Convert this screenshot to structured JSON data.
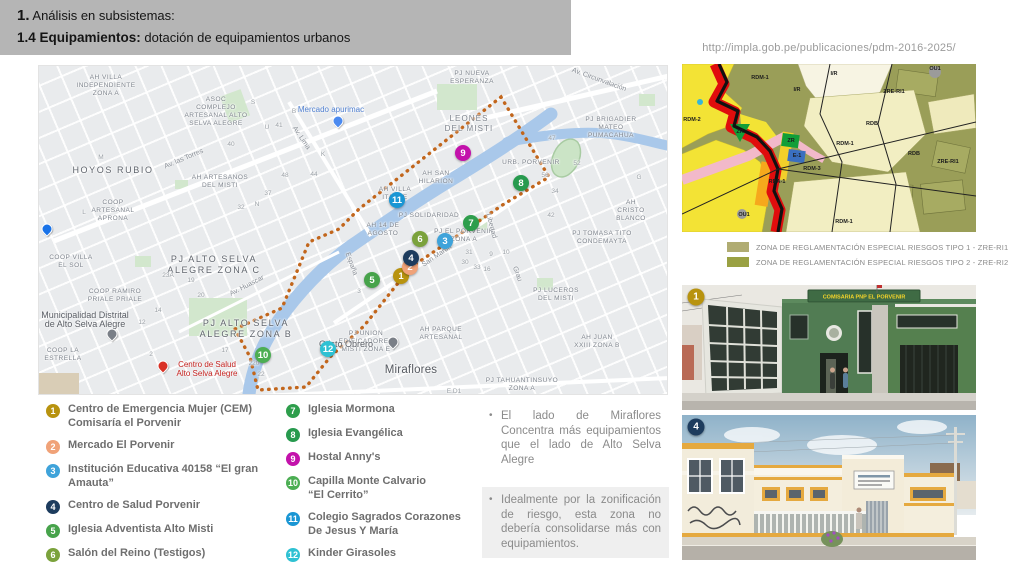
{
  "header": {
    "num1": "1.",
    "title1": " Análisis en subsistemas:",
    "num2": "1.4 Equipamientos:",
    "title2": " dotación de equipamientos urbanos"
  },
  "source_url": "http://impla.gob.pe/publicaciones/pdm-2016-2025/",
  "map": {
    "boundary_color": "#c2661c",
    "markers": [
      {
        "n": "9",
        "x": 424,
        "y": 87,
        "color": "#c312ab"
      },
      {
        "n": "8",
        "x": 482,
        "y": 117,
        "color": "#279a4e"
      },
      {
        "n": "7",
        "x": 432,
        "y": 157,
        "color": "#2e9e4c"
      },
      {
        "n": "6",
        "x": 381,
        "y": 173,
        "color": "#7ba23c"
      },
      {
        "n": "3",
        "x": 406,
        "y": 175,
        "color": "#3fa3da"
      },
      {
        "n": "5",
        "x": 333,
        "y": 214,
        "color": "#47a34b"
      },
      {
        "n": "11",
        "x": 358,
        "y": 134,
        "color": "#1a96d4"
      },
      {
        "n": "10",
        "x": 224,
        "y": 289,
        "color": "#4cae53"
      },
      {
        "n": "12",
        "x": 289,
        "y": 283,
        "color": "#2fc1d3"
      },
      {
        "n": "1",
        "x": 362,
        "y": 210,
        "color": "#b8930f"
      },
      {
        "n": "2",
        "x": 371,
        "y": 201,
        "color": "#f0a278"
      },
      {
        "n": "4",
        "x": 372,
        "y": 192,
        "color": "#1d3c5e"
      }
    ],
    "labels": [
      {
        "t": "AH VILLA\nINDEPENDIENTE\nZONA A",
        "x": 67,
        "y": 8
      },
      {
        "t": "ASOC\nCOMPLEJO\nARTESANAL ALTO\nSELVA ALEGRE",
        "x": 177,
        "y": 30
      },
      {
        "t": "PJ NUEVA\nESPERANZA",
        "x": 433,
        "y": 4
      },
      {
        "t": "LEONES\nDEL MISTI",
        "x": 430,
        "y": 48,
        "cls": "area-lg"
      },
      {
        "t": "PJ BRIGADIER\nMATEO\nPUMACAHUA",
        "x": 572,
        "y": 50
      },
      {
        "t": "HOYOS RUBIO",
        "x": 74,
        "y": 99,
        "cls": "big"
      },
      {
        "t": "AH ARTESANOS\nDEL MISTI",
        "x": 181,
        "y": 108
      },
      {
        "t": "COOP\nARTESANAL\nAPRONA",
        "x": 74,
        "y": 133
      },
      {
        "t": "AH SAN\nHILARION",
        "x": 397,
        "y": 104
      },
      {
        "t": "URB. PORVENIR",
        "x": 492,
        "y": 93
      },
      {
        "t": "AH VILLA\nITARTE",
        "x": 356,
        "y": 120
      },
      {
        "t": "AH CRISTO\nBLANCO",
        "x": 592,
        "y": 133
      },
      {
        "t": "PJ SOLIDARIDAD",
        "x": 390,
        "y": 146
      },
      {
        "t": "AH 14 DE\nAGOSTO",
        "x": 344,
        "y": 156
      },
      {
        "t": "PJ EL PORVENIR\nZONA A",
        "x": 425,
        "y": 162
      },
      {
        "t": "PJ TOMASA TITO\nCONDEMAYTA",
        "x": 563,
        "y": 164
      },
      {
        "t": "PJ ALTO SELVA\nALEGRE ZONA C",
        "x": 175,
        "y": 188,
        "cls": "big"
      },
      {
        "t": "COOP VILLA\nEL SOL",
        "x": 32,
        "y": 188
      },
      {
        "t": "COOP RAMIRO\nPRIALE PRIALE",
        "x": 76,
        "y": 222
      },
      {
        "t": "PJ ALTO SELVA\nALEGRE ZONA B",
        "x": 207,
        "y": 252,
        "cls": "big"
      },
      {
        "t": "PJ UNION\nEDIFICADORES\nMISTI ZONA E",
        "x": 327,
        "y": 264
      },
      {
        "t": "AH PARQUE\nARTESANAL",
        "x": 402,
        "y": 260
      },
      {
        "t": "PJ LUCEROS\nDEL MISTI",
        "x": 517,
        "y": 221
      },
      {
        "t": "COOP LA\nESTRELLA",
        "x": 24,
        "y": 281
      },
      {
        "t": "PJ TAHUANTINSUYO\nZONA A",
        "x": 483,
        "y": 311
      },
      {
        "t": "AH JUAN\nXXIII ZONA B",
        "x": 558,
        "y": 268
      },
      {
        "t": "Miraflores",
        "x": 372,
        "y": 298,
        "cls": "city"
      },
      {
        "t": "40",
        "x": 192,
        "y": 75,
        "cls": "num"
      },
      {
        "t": "41",
        "x": 240,
        "y": 56,
        "cls": "num"
      },
      {
        "t": "48",
        "x": 246,
        "y": 106,
        "cls": "num"
      },
      {
        "t": "44",
        "x": 275,
        "y": 105,
        "cls": "num"
      },
      {
        "t": "37",
        "x": 229,
        "y": 124,
        "cls": "num"
      },
      {
        "t": "32",
        "x": 202,
        "y": 138,
        "cls": "num"
      },
      {
        "t": "52",
        "x": 538,
        "y": 94,
        "cls": "num"
      },
      {
        "t": "47",
        "x": 513,
        "y": 69,
        "cls": "num"
      },
      {
        "t": "56",
        "x": 506,
        "y": 106,
        "cls": "num"
      },
      {
        "t": "34",
        "x": 516,
        "y": 122,
        "cls": "num"
      },
      {
        "t": "42",
        "x": 512,
        "y": 146,
        "cls": "num"
      },
      {
        "t": "23A",
        "x": 129,
        "y": 206,
        "cls": "num"
      },
      {
        "t": "19",
        "x": 152,
        "y": 211,
        "cls": "num"
      },
      {
        "t": "20",
        "x": 162,
        "y": 226,
        "cls": "num"
      },
      {
        "t": "14",
        "x": 119,
        "y": 241,
        "cls": "num"
      },
      {
        "t": "12",
        "x": 103,
        "y": 253,
        "cls": "num"
      },
      {
        "t": "17",
        "x": 186,
        "y": 281,
        "cls": "num"
      },
      {
        "t": "220",
        "x": 215,
        "y": 294,
        "cls": "num"
      },
      {
        "t": "22",
        "x": 222,
        "y": 305,
        "cls": "num"
      },
      {
        "t": "31",
        "x": 430,
        "y": 183,
        "cls": "num"
      },
      {
        "t": "30",
        "x": 426,
        "y": 193,
        "cls": "num"
      },
      {
        "t": "33",
        "x": 438,
        "y": 198,
        "cls": "num"
      },
      {
        "t": "9",
        "x": 452,
        "y": 185,
        "cls": "num"
      },
      {
        "t": "10",
        "x": 467,
        "y": 183,
        "cls": "num"
      },
      {
        "t": "16",
        "x": 448,
        "y": 200,
        "cls": "num"
      },
      {
        "t": "3",
        "x": 320,
        "y": 222,
        "cls": "num"
      },
      {
        "t": "2",
        "x": 112,
        "y": 285,
        "cls": "num"
      },
      {
        "t": "B",
        "x": 255,
        "y": 42,
        "cls": "num"
      },
      {
        "t": "S",
        "x": 214,
        "y": 33,
        "cls": "num"
      },
      {
        "t": "M",
        "x": 62,
        "y": 88,
        "cls": "num"
      },
      {
        "t": "N",
        "x": 218,
        "y": 135,
        "cls": "num"
      },
      {
        "t": "K",
        "x": 284,
        "y": 85,
        "cls": "num"
      },
      {
        "t": "U",
        "x": 228,
        "y": 58,
        "cls": "num"
      },
      {
        "t": "L",
        "x": 45,
        "y": 143,
        "cls": "num"
      },
      {
        "t": "G",
        "x": 600,
        "y": 108,
        "cls": "num"
      },
      {
        "t": "E.D1",
        "x": 415,
        "y": 322,
        "cls": "num"
      }
    ],
    "streets": [
      {
        "t": "Av. las Torres",
        "x": 145,
        "y": 93,
        "r": -23
      },
      {
        "t": "Av. Lima",
        "x": 262,
        "y": 72,
        "r": 56
      },
      {
        "t": "Av. Circunvalación",
        "x": 560,
        "y": 14,
        "r": 20
      },
      {
        "t": "San Martín",
        "x": 398,
        "y": 190,
        "r": -34
      },
      {
        "t": "Av. Huascar",
        "x": 208,
        "y": 220,
        "r": -27
      },
      {
        "t": "España",
        "x": 312,
        "y": 198,
        "r": 70
      },
      {
        "t": "Libertad",
        "x": 452,
        "y": 160,
        "r": 75
      },
      {
        "t": "Grau",
        "x": 478,
        "y": 208,
        "r": 70
      }
    ],
    "pois": [
      {
        "t": "Mercado apurimac",
        "x": 292,
        "y": 39,
        "cls": "blue"
      },
      {
        "t": "Municipalidad Distrital\nde Alto Selva Alegre",
        "x": 46,
        "y": 245,
        "cls": "dark"
      },
      {
        "t": "Centro de Salud\nAlto Selva Alegre",
        "x": 168,
        "y": 294,
        "cls": "red"
      },
      {
        "t": "Cristo Obrero",
        "x": 307,
        "y": 274,
        "cls": "dark"
      }
    ],
    "pins": [
      {
        "x": 299,
        "y": 55,
        "c": "#4b8af0",
        "name": "market-pin"
      },
      {
        "x": 73,
        "y": 268,
        "c": "#7a7f87",
        "name": "municipality-pin"
      },
      {
        "x": 124,
        "y": 300,
        "c": "#d93025",
        "name": "hospital-pin"
      },
      {
        "x": 354,
        "y": 276,
        "c": "#7a7f87",
        "name": "church-pin"
      },
      {
        "x": 8,
        "y": 163,
        "c": "#1a73e8",
        "name": "transit-pin"
      }
    ]
  },
  "zoning": {
    "labels": [
      {
        "t": "RDM-1",
        "x": 78,
        "y": 14
      },
      {
        "t": "I/R",
        "x": 115,
        "y": 26
      },
      {
        "t": "I/R",
        "x": 152,
        "y": 10
      },
      {
        "t": "RDM-2",
        "x": 10,
        "y": 56
      },
      {
        "t": "ZR",
        "x": 58,
        "y": 68
      },
      {
        "t": "ZR",
        "x": 109,
        "y": 77
      },
      {
        "t": "E-1",
        "x": 115,
        "y": 92
      },
      {
        "t": "RDM-3",
        "x": 130,
        "y": 105
      },
      {
        "t": "RDA-1",
        "x": 95,
        "y": 118
      },
      {
        "t": "OU1",
        "x": 62,
        "y": 151
      },
      {
        "t": "RDM-1",
        "x": 163,
        "y": 80
      },
      {
        "t": "RDB",
        "x": 190,
        "y": 60
      },
      {
        "t": "RDB",
        "x": 232,
        "y": 90
      },
      {
        "t": "ZRE-RI1",
        "x": 212,
        "y": 28
      },
      {
        "t": "ZRE-RI1",
        "x": 266,
        "y": 98
      },
      {
        "t": "RDM-1",
        "x": 162,
        "y": 158
      },
      {
        "t": "OU1",
        "x": 253,
        "y": 5
      }
    ],
    "legend": [
      {
        "color": "#b0ac72",
        "text": "ZONA DE REGLAMENTACIÓN ESPECIAL RIESGOS TIPO 1 - ZRE-RI1"
      },
      {
        "color": "#9aa143",
        "text": "ZONA DE REGLAMENTACIÓN ESPECIAL RIESGOS TIPO 2 - ZRE-RI2"
      }
    ]
  },
  "photos": [
    {
      "badge": "1",
      "badge_color": "#b8930f",
      "x": 696,
      "y": 297,
      "sign": "COMISARIA PNP EL PORVENIR"
    },
    {
      "badge": "4",
      "badge_color": "#1d3c5e",
      "x": 696,
      "y": 427,
      "sign": ""
    }
  ],
  "legend_items": [
    {
      "num": "1",
      "color": "#b8930f",
      "lines": [
        "Centro de Emergencia Mujer (CEM)",
        "Comisaría el Porvenir"
      ]
    },
    {
      "num": "2",
      "color": "#f0a278",
      "lines": [
        "Mercado El Porvenir"
      ]
    },
    {
      "num": "3",
      "color": "#3fa3da",
      "lines": [
        "Institución Educativa 40158 “El gran",
        "Amauta”"
      ]
    },
    {
      "num": "4",
      "color": "#1d3c5e",
      "lines": [
        "Centro de Salud Porvenir"
      ]
    },
    {
      "num": "5",
      "color": "#47a34b",
      "lines": [
        "Iglesia Adventista Alto Misti"
      ]
    },
    {
      "num": "6",
      "color": "#7ba23c",
      "lines": [
        "Salón del Reino (Testigos)"
      ]
    },
    {
      "num": "7",
      "color": "#2e9e4c",
      "lines": [
        "Iglesia Mormona"
      ]
    },
    {
      "num": "8",
      "color": "#279a4e",
      "lines": [
        "Iglesia Evangélica"
      ]
    },
    {
      "num": "9",
      "color": "#c312ab",
      "lines": [
        "Hostal Anny's"
      ]
    },
    {
      "num": "10",
      "color": "#4cae53",
      "lines": [
        "Capilla Monte Calvario",
        "“El Cerrito”"
      ]
    },
    {
      "num": "11",
      "color": "#1a96d4",
      "lines": [
        "Colegio Sagrados Corazones",
        "De Jesus Y María"
      ]
    },
    {
      "num": "12",
      "color": "#2fc1d3",
      "lines": [
        "Kinder Girasoles"
      ]
    }
  ],
  "notes": [
    {
      "text": "El lado de Miraflores Concentra más equipamientos que el lado de Alto Selva Alegre",
      "highlight": false
    },
    {
      "text": "Idealmente por la zonificación de riesgo, esta zona no debería consolidarse más con equipamientos.",
      "highlight": true
    }
  ]
}
